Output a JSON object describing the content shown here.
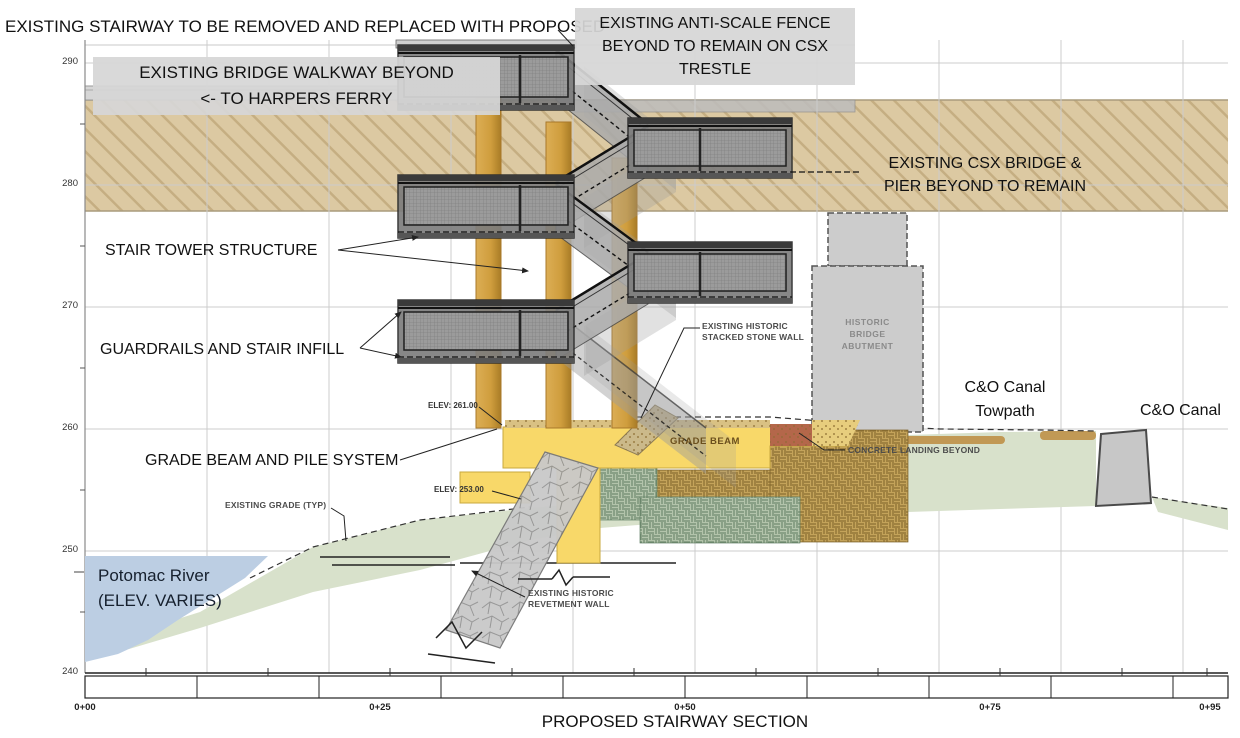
{
  "title": "PROPOSED STAIRWAY SECTION",
  "axis": {
    "elevations": [
      "290",
      "280",
      "270",
      "260",
      "250",
      "240"
    ],
    "stations": [
      "0+00",
      "0+25",
      "0+50",
      "0+75",
      "0+95"
    ]
  },
  "annotations": {
    "stairway_removed": "EXISTING STAIRWAY TO BE REMOVED AND REPLACED WITH PROPOSED",
    "anti_scale_fence": [
      "EXISTING ANTI-SCALE FENCE",
      "BEYOND TO REMAIN ON CSX",
      "TRESTLE"
    ],
    "bridge_walkway": [
      "EXISTING BRIDGE WALKWAY BEYOND",
      "<- TO HARPERS FERRY"
    ],
    "csx_bridge": [
      "EXISTING CSX BRIDGE &",
      "PIER BEYOND TO REMAIN"
    ],
    "stair_tower": "STAIR TOWER STRUCTURE",
    "guardrails": "GUARDRAILS AND STAIR INFILL",
    "stacked_stone": [
      "EXISTING HISTORIC",
      "STACKED STONE WALL"
    ],
    "historic_abutment": [
      "HISTORIC",
      "BRIDGE",
      "ABUTMENT"
    ],
    "towpath": [
      "C&O Canal",
      "Towpath"
    ],
    "canal": "C&O Canal",
    "grade_beam_pile": "GRADE BEAM AND PILE SYSTEM",
    "elev_261": "ELEV: 261.00",
    "grade_beam": "GRADE BEAM",
    "concrete_landing": "CONCRETE LANDING BEYOND",
    "existing_grade": "EXISTING GRADE (TYP)",
    "elev_253": "ELEV: 253.00",
    "potomac": [
      "Potomac River",
      "(ELEV. VARIES)"
    ],
    "revetment": [
      "EXISTING HISTORIC",
      "REVETMENT WALL"
    ]
  },
  "colors": {
    "csx_band": "#dcc9a2",
    "amber_pile": "#cf9d3d",
    "grade_beam_yellow": "#f8d869",
    "ground_green": "#d8e1cb",
    "river_blue": "#bccee3",
    "towpath_soil": "#c0954e",
    "structure_gray": "#808080",
    "abutment_gray": "#cccccc",
    "brown_fill_hatch": "#c4a35a",
    "green_fill_hatch": "#b3c4ab",
    "label_box_gray": "#d6d6d6"
  }
}
